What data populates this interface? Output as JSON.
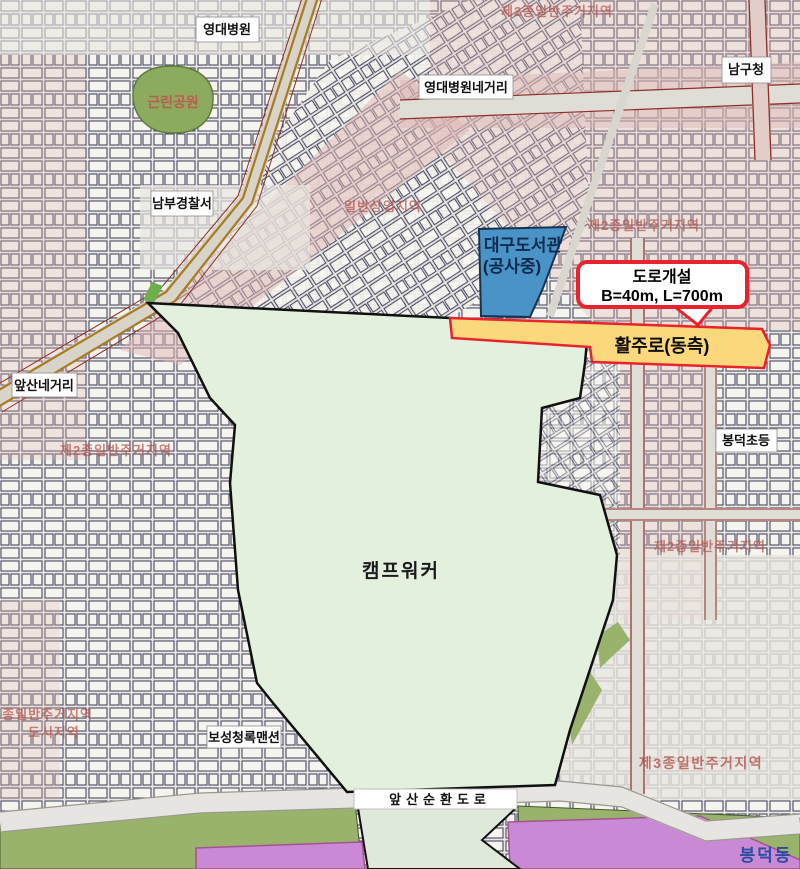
{
  "colors": {
    "map_background": "#eae8e2",
    "district_pink": "#ddb6b3",
    "camp_green": "#e3f0dd",
    "camp_border": "#101010",
    "runway_yellow": "#fcd87d",
    "annotation_red": "#e8232d",
    "library_blue": "#4a93c6",
    "library_text_navy": "#0e2a4e",
    "park_green": "#8cab5f",
    "olive_green": "#9ab36c",
    "purple_zone": "#c989d4",
    "zone_text_red": "#b5534e",
    "park_text_red": "#c0504d",
    "road_edge_red": "#8c2f2a",
    "dong_text_blue": "#2b4ea0"
  },
  "annotations": {
    "library": {
      "line1": "대구도서관",
      "line2": "(공사중)"
    },
    "road_callout": {
      "line1": "도로개설",
      "line2": "B=40m, L=700m"
    },
    "runway_label": "활주로(동측)",
    "camp_label": "캠프워커"
  },
  "place_labels": {
    "yeongdae_hospital": "영대병원",
    "yeongdae_intersection": "영대병원네거리",
    "namgu_office": "남구청",
    "nambu_police": "남부경찰서",
    "apsan_intersection": "앞산네거리",
    "bongdeok_elementary": "봉덕초등",
    "boseong_mansion": "보성청록맨션",
    "ring_road": "앞산순환도로",
    "neighborhood_park": "근린공원",
    "bongdeok_dong": "봉덕동"
  },
  "zone_labels": {
    "residential2": "제2종일반주거지역",
    "residential3": "제3종일반주거지역",
    "residential1": "1종일반주거지역",
    "urban_area": "도시지역",
    "commercial": "일반상업지역"
  }
}
